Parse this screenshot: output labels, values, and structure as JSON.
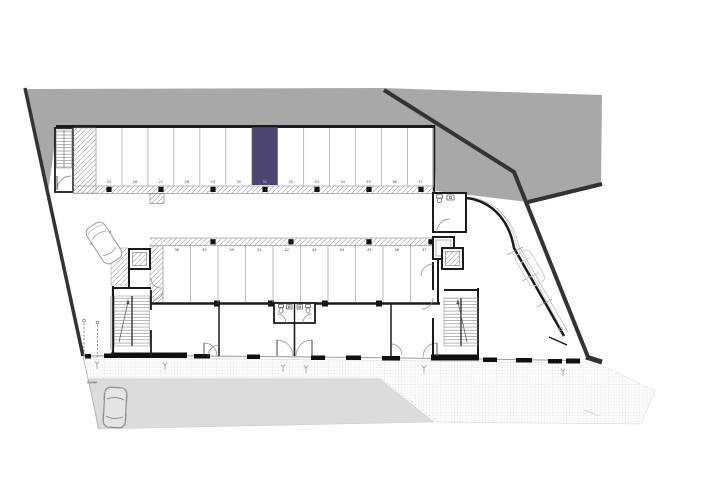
{
  "floor_plan": {
    "parking": {
      "top_row_numbers": [
        "25",
        "26",
        "27",
        "28",
        "29",
        "30",
        "31",
        "32",
        "33",
        "34",
        "35",
        "36",
        "37"
      ],
      "middle_row_numbers": [
        "38",
        "39",
        "40",
        "41",
        "42",
        "43",
        "44",
        "45",
        "46",
        "47"
      ],
      "highlighted_space": "31"
    },
    "labels": {
      "ramp": "RAMPA"
    },
    "colors": {
      "highlight": "#4a4671",
      "terrain": "#a8a8a8",
      "street": "#dcdcdc",
      "wall": "#1b1b1b",
      "boundary": "#333333"
    }
  }
}
